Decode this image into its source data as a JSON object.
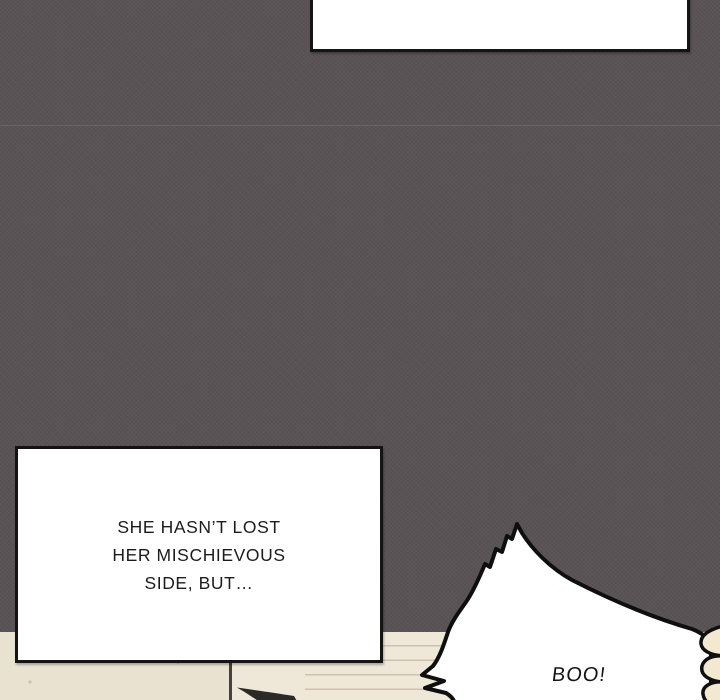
{
  "comic": {
    "top_caption": {
      "text": ""
    },
    "narration": {
      "lines": [
        "SHE HASN’T LOST",
        "HER MISCHIEVOUS",
        "SIDE, BUT…"
      ]
    },
    "shout": {
      "text": "BOO!"
    }
  },
  "colors": {
    "panel_background": "#5a5355",
    "caption_fill": "#ffffff",
    "outline": "#141414",
    "wall_left": "#e9e2d1",
    "wall_right": "#efe8d8",
    "hand_fill": "#f2e9d0",
    "text": "#1c1c1c"
  }
}
